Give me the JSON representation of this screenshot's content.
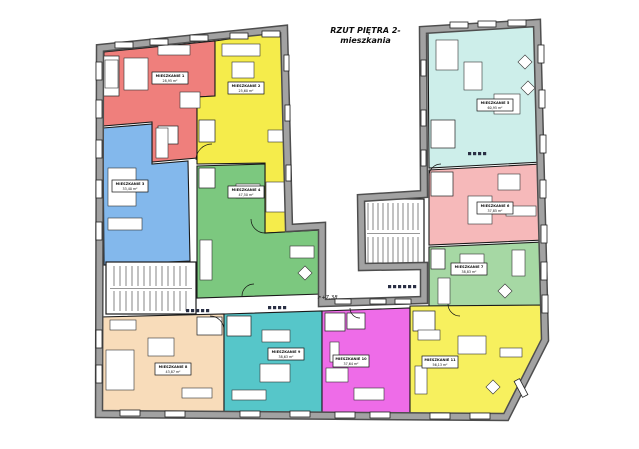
{
  "title": {
    "line1": "RZUT PIĘTRA 2-",
    "line2": "mieszkania"
  },
  "elevation_marker": "+7,38",
  "colors": {
    "background": "#ffffff",
    "wall_core": "#a2a2a2",
    "wall_edge": "#4e4e4e",
    "partition_line": "#1a1a1a",
    "label_plate": "#ffffff"
  },
  "apartments": [
    {
      "id": "apartment-1",
      "label": "MIESZKANIE 1",
      "area": "28,95 m²",
      "color": "#ef7f7c",
      "points": "104,52 215,41 215,96 197,97 197,158 152,162 152,122 103,126",
      "label_cx": 170,
      "label_cy": 78
    },
    {
      "id": "apartment-2",
      "label": "MIESZKANIE 2",
      "area": "25,60 m²",
      "color": "#f5ec4b",
      "points": "215,41 284,31 288,232 265,233 265,163 197,164 197,97 215,96",
      "label_cx": 246,
      "label_cy": 88
    },
    {
      "id": "apartment-3",
      "label": "MIESZKANIE 3",
      "area": "33,40 m²",
      "color": "#83b8ec",
      "points": "103,128 152,124 152,164 188,161 190,261 104,265",
      "label_cx": 130,
      "label_cy": 186
    },
    {
      "id": "apartment-4",
      "label": "MIESZKANIE 4",
      "area": "47,50 m²",
      "color": "#7cc87f",
      "points": "197,166 265,164 265,233 322,230 322,294 197,298",
      "label_cx": 246,
      "label_cy": 192
    },
    {
      "id": "apartment-5",
      "label": "MIESZKANIE 5",
      "area": "60,95 m²",
      "color": "#cdeeea",
      "points": "428,31 536,24 542,162 429,168",
      "label_cx": 495,
      "label_cy": 105
    },
    {
      "id": "apartment-6",
      "label": "MIESZKANIE 6",
      "area": "37,85 m²",
      "color": "#f6b9ba",
      "points": "429,170 542,164 544,240 429,245",
      "label_cx": 495,
      "label_cy": 208
    },
    {
      "id": "apartment-7",
      "label": "MIESZKANIE 7",
      "area": "38,83 m²",
      "color": "#a6d8a4",
      "points": "429,247 544,242 545,306 429,310",
      "label_cx": 469,
      "label_cy": 269
    },
    {
      "id": "apartment-8",
      "label": "MIESZKANIE 8",
      "area": "43,87 m²",
      "color": "#f8dcba",
      "points": "100,317 224,314 224,414 99,413",
      "label_cx": 173,
      "label_cy": 369
    },
    {
      "id": "apartment-9",
      "label": "MIESZKANIE 9",
      "area": "38,63 m²",
      "color": "#56c6c9",
      "points": "224,314 322,311 322,414 224,414",
      "label_cx": 286,
      "label_cy": 354
    },
    {
      "id": "apartment-10",
      "label": "MIESZKANIE 10",
      "area": "37,64 m²",
      "color": "#ee6ce8",
      "points": "322,311 410,308 410,415 322,414",
      "label_cx": 351,
      "label_cy": 361
    },
    {
      "id": "apartment-11",
      "label": "MIESZKANIE 11",
      "area": "56,13 m²",
      "color": "#f7f05e",
      "points": "410,306 545,305 546,341 506,416 410,415",
      "label_cx": 440,
      "label_cy": 362
    }
  ],
  "stairwells": [
    {
      "id": "stairwell-left"
    },
    {
      "id": "stairwell-right"
    }
  ]
}
